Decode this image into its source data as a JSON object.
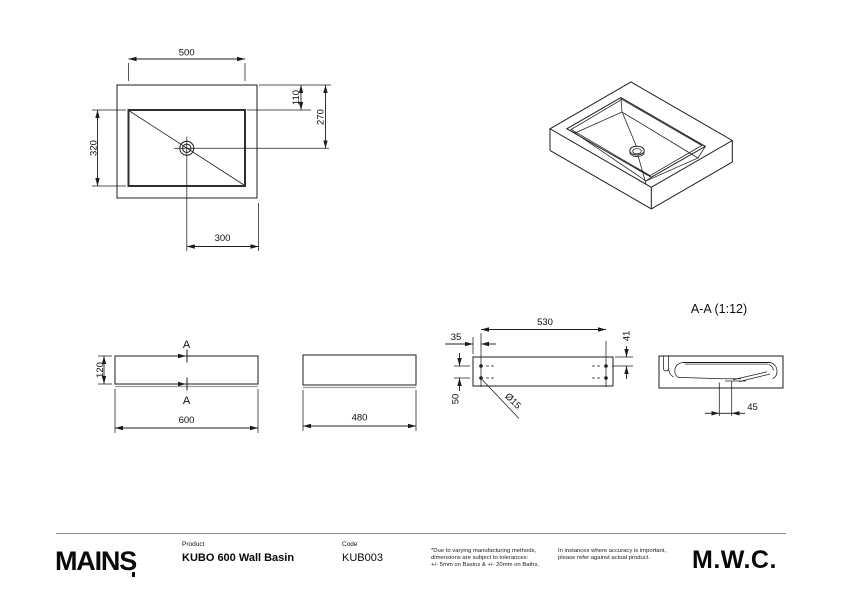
{
  "drawing": {
    "plan": {
      "dim_inner_width": "500",
      "dim_inner_depth": "320",
      "dim_basin_top_offset": "110",
      "dim_drain_from_back": "270",
      "dim_drain_from_side": "300"
    },
    "front": {
      "dim_height": "120",
      "dim_width": "600",
      "section_label_top": "A",
      "section_label_bottom": "A"
    },
    "side": {
      "dim_depth": "480"
    },
    "rear": {
      "dim_fixing_span": "530",
      "dim_fixing_edge": "35",
      "dim_fixing_top": "41",
      "dim_fixing_gap": "50",
      "dim_fixing_dia": "Ø15"
    },
    "section": {
      "title": "A-A (1:12)",
      "dim_outlet_offset": "45"
    }
  },
  "footer": {
    "brand": "MAINS",
    "product_label": "Product",
    "product_value": "KUBO 600 Wall Basin",
    "code_label": "Code",
    "code_value": "KUB003",
    "disclaimer_tolerances": "*Due to varying manufacturing methods,\ndimensions are subject to tolerances:\n+/- 5mm on Basins & +/- 20mm on Baths.",
    "disclaimer_accuracy": "In instances where accuracy is important,\nplease refer against actual product.",
    "manufacturer": "M.W.C."
  }
}
